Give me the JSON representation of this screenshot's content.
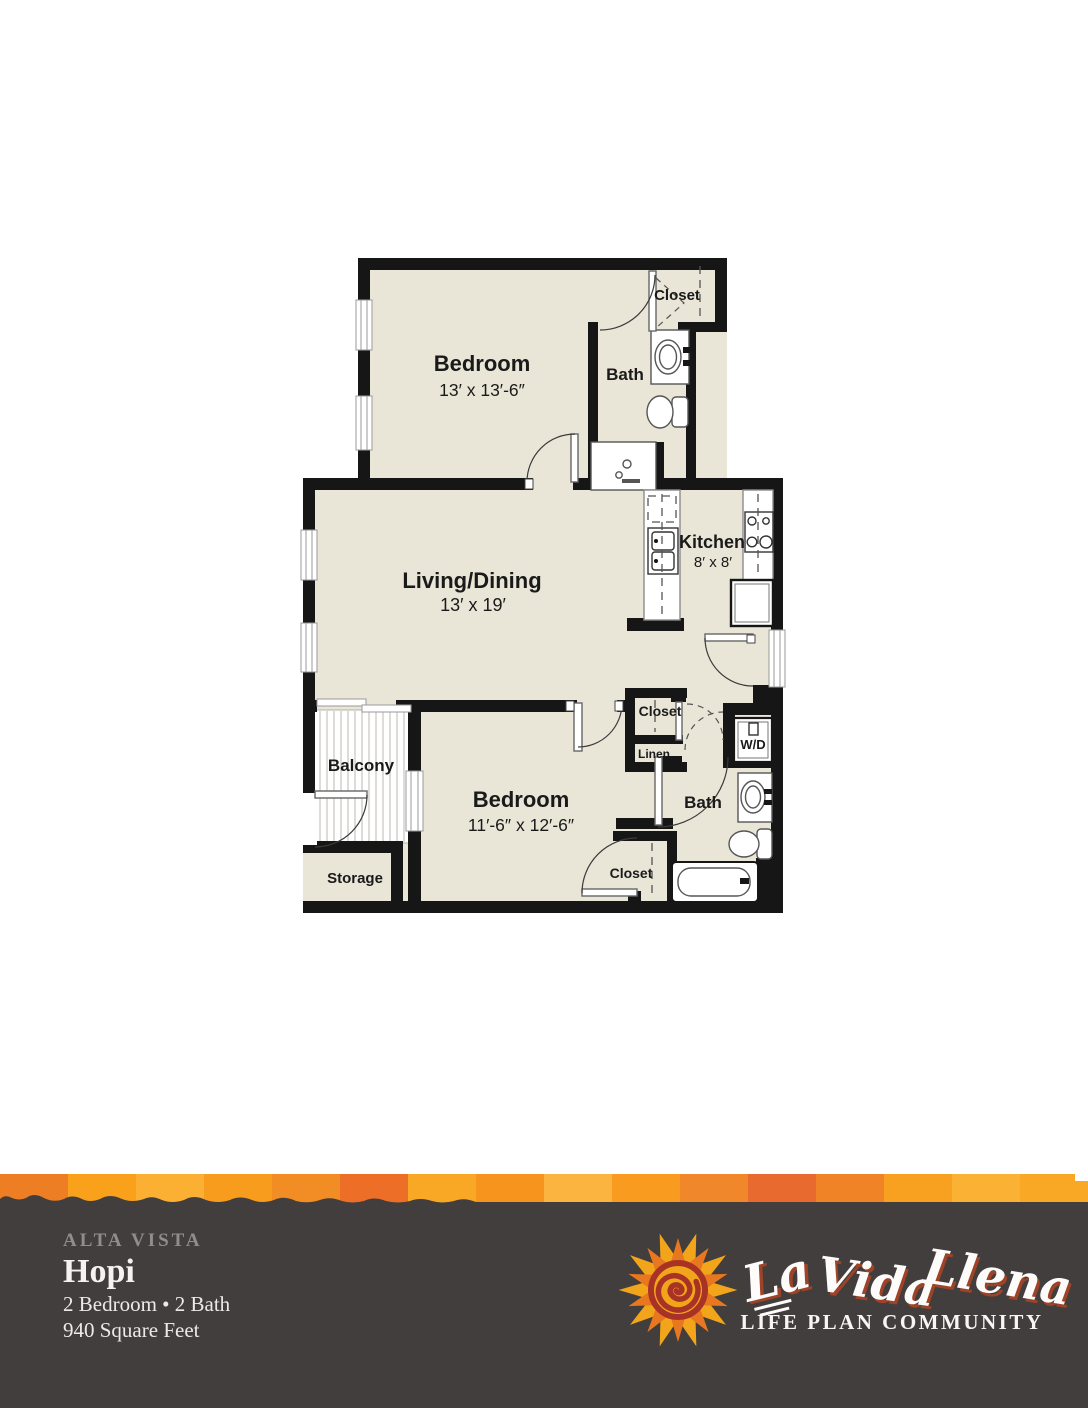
{
  "floorplan": {
    "rooms": {
      "bedroom1": {
        "label": "Bedroom",
        "dims": "13′ x 13′-6″"
      },
      "closet1": {
        "label": "Closet"
      },
      "bath1": {
        "label": "Bath"
      },
      "living": {
        "label": "Living/Dining",
        "dims": "13′ x 19′"
      },
      "kitchen": {
        "label": "Kitchen",
        "dims": "8′ x 8′"
      },
      "balcony": {
        "label": "Balcony"
      },
      "storage": {
        "label": "Storage"
      },
      "bedroom2": {
        "label": "Bedroom",
        "dims": "11′-6″ x 12′-6″"
      },
      "closet2": {
        "label": "Closet"
      },
      "linen": {
        "label": "Linen"
      },
      "washer_dryer": {
        "label": "W/D"
      },
      "bath2": {
        "label": "Bath"
      },
      "closet3": {
        "label": "Closet"
      }
    },
    "colors": {
      "floor": "#e9e6d7",
      "wall": "#161616",
      "balcony_stripe": "#cbc9c4"
    }
  },
  "footer": {
    "community": "ALTA VISTA",
    "plan_name": "Hopi",
    "specs": "2 Bedroom • 2 Bath",
    "area": "940 Square Feet",
    "background": "#423e3d",
    "community_color": "#908d8b",
    "accent_bar_colors": [
      "#ee7e23",
      "#f9a11b",
      "#fbb034",
      "#f89c1e",
      "#f28c24",
      "#ec6e27",
      "#f9a825",
      "#f7941d",
      "#fbb440",
      "#f89b1f",
      "#f0872a",
      "#e96a2e",
      "#f08326",
      "#f8a01f",
      "#fbb234",
      "#f9a825"
    ],
    "logo": {
      "icon": "sun-spiral-icon",
      "word1": "La",
      "word2": "Vida",
      "word3": "Llena",
      "tagline": "LIFE PLAN COMMUNITY",
      "sun_orange": "#e8771f",
      "sun_yellow": "#f2a51a",
      "sun_red": "#a93226"
    }
  }
}
